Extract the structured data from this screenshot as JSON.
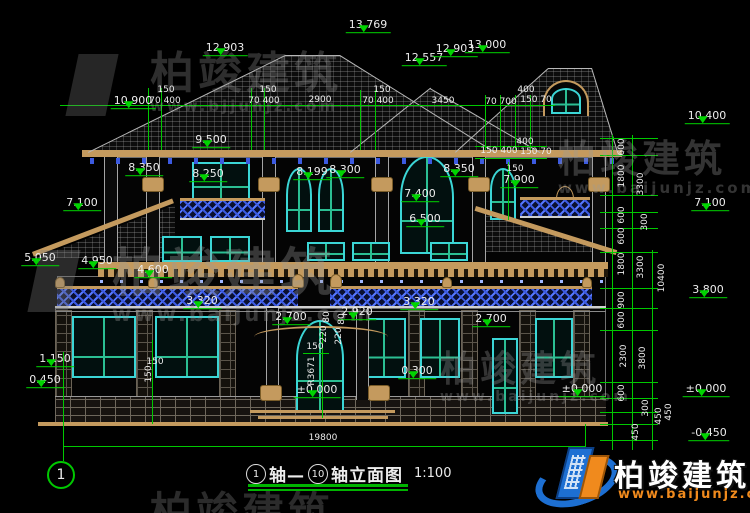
{
  "page": {
    "background": "#000000"
  },
  "colors": {
    "dim_green": "#00d400",
    "text_white": "#ececec",
    "tan_trim": "#c49a5e",
    "window_cyan": "#3bd6d6",
    "mullion_green": "#2bbf93",
    "railing_blue": "#3c5ae0",
    "logo_blue": "#1d6fd2",
    "logo_orange": "#f08a1d"
  },
  "annotations": {
    "elevations": [
      {
        "t": "13.769",
        "x": 368,
        "y": 33
      },
      {
        "t": "12.903",
        "x": 225,
        "y": 56
      },
      {
        "t": "12.557",
        "x": 424,
        "y": 66
      },
      {
        "t": "12.903",
        "x": 455,
        "y": 57
      },
      {
        "t": "13.000",
        "x": 487,
        "y": 53
      },
      {
        "t": "10.900",
        "x": 133,
        "y": 109
      },
      {
        "t": "10.400",
        "x": 707,
        "y": 124
      },
      {
        "t": "9.500",
        "x": 211,
        "y": 148
      },
      {
        "t": "8.350",
        "x": 144,
        "y": 176
      },
      {
        "t": "8.250",
        "x": 208,
        "y": 182
      },
      {
        "t": "8.199",
        "x": 312,
        "y": 180
      },
      {
        "t": "8.300",
        "x": 345,
        "y": 178
      },
      {
        "t": "8.350",
        "x": 459,
        "y": 177
      },
      {
        "t": "7.900",
        "x": 519,
        "y": 188
      },
      {
        "t": "7.100",
        "x": 82,
        "y": 211
      },
      {
        "t": "7.100",
        "x": 710,
        "y": 211
      },
      {
        "t": "7.400",
        "x": 420,
        "y": 202
      },
      {
        "t": "6.500",
        "x": 425,
        "y": 227
      },
      {
        "t": "5.050",
        "x": 40,
        "y": 266
      },
      {
        "t": "4.950",
        "x": 97,
        "y": 269
      },
      {
        "t": "4.600",
        "x": 153,
        "y": 278
      },
      {
        "t": "3.800",
        "x": 708,
        "y": 298
      },
      {
        "t": "3.320",
        "x": 202,
        "y": 309
      },
      {
        "t": "3.320",
        "x": 419,
        "y": 310
      },
      {
        "t": "2.920",
        "x": 357,
        "y": 320
      },
      {
        "t": "2.700",
        "x": 291,
        "y": 325
      },
      {
        "t": "2.700",
        "x": 491,
        "y": 327
      },
      {
        "t": "1.150",
        "x": 55,
        "y": 367
      },
      {
        "t": "0.450",
        "x": 45,
        "y": 388
      },
      {
        "t": "0.300",
        "x": 417,
        "y": 379
      },
      {
        "t": "±0.000",
        "x": 317,
        "y": 398
      },
      {
        "t": "±0.000",
        "x": 582,
        "y": 397
      },
      {
        "t": "±0.000",
        "x": 706,
        "y": 397
      },
      {
        "t": "-0.450",
        "x": 709,
        "y": 441
      }
    ],
    "dims": [
      {
        "t": "150",
        "x": 166,
        "y": 90
      },
      {
        "t": "70 400",
        "x": 165,
        "y": 101
      },
      {
        "t": "150",
        "x": 268,
        "y": 90
      },
      {
        "t": "70 400",
        "x": 264,
        "y": 101
      },
      {
        "t": "2900",
        "x": 320,
        "y": 100
      },
      {
        "t": "150",
        "x": 382,
        "y": 90
      },
      {
        "t": "70 400",
        "x": 378,
        "y": 101
      },
      {
        "t": "3450",
        "x": 443,
        "y": 101
      },
      {
        "t": "70 700",
        "x": 501,
        "y": 102
      },
      {
        "t": "400",
        "x": 526,
        "y": 90
      },
      {
        "t": "150 70",
        "x": 536,
        "y": 100
      },
      {
        "t": "400",
        "x": 525,
        "y": 142
      },
      {
        "t": "150 400",
        "x": 499,
        "y": 151
      },
      {
        "t": "150 70",
        "x": 536,
        "y": 152
      },
      {
        "t": "150",
        "x": 515,
        "y": 169
      },
      {
        "t": "150",
        "x": 315,
        "y": 347
      },
      {
        "t": "150",
        "x": 155,
        "y": 362
      },
      {
        "t": "19800",
        "x": 323,
        "y": 438
      }
    ],
    "dims_rotated": [
      {
        "t": "600",
        "x": 622,
        "y": 147
      },
      {
        "t": "1800",
        "x": 622,
        "y": 176
      },
      {
        "t": "600",
        "x": 622,
        "y": 215
      },
      {
        "t": "600",
        "x": 622,
        "y": 236
      },
      {
        "t": "1800",
        "x": 622,
        "y": 264
      },
      {
        "t": "900",
        "x": 622,
        "y": 300
      },
      {
        "t": "600",
        "x": 622,
        "y": 320
      },
      {
        "t": "2300",
        "x": 624,
        "y": 356
      },
      {
        "t": "600",
        "x": 622,
        "y": 393
      },
      {
        "t": "450",
        "x": 636,
        "y": 432
      },
      {
        "t": "3300",
        "x": 641,
        "y": 184
      },
      {
        "t": "300",
        "x": 645,
        "y": 222
      },
      {
        "t": "3300",
        "x": 641,
        "y": 267
      },
      {
        "t": "3800",
        "x": 643,
        "y": 358
      },
      {
        "t": "300",
        "x": 646,
        "y": 408
      },
      {
        "t": "450",
        "x": 659,
        "y": 416
      },
      {
        "t": "450",
        "x": 669,
        "y": 412
      },
      {
        "t": "10400",
        "x": 662,
        "y": 278
      },
      {
        "t": "150",
        "x": 149,
        "y": 374
      },
      {
        "t": "R3671",
        "x": 312,
        "y": 371
      },
      {
        "t": "80",
        "x": 327,
        "y": 317
      },
      {
        "t": "220",
        "x": 324,
        "y": 334
      },
      {
        "t": "80",
        "x": 342,
        "y": 319
      },
      {
        "t": "220",
        "x": 339,
        "y": 336
      }
    ]
  },
  "watermarks": [
    {
      "text": "柏竣建筑",
      "sub": "www.bjjunjz.com",
      "x": 150,
      "y": 52,
      "size": 44,
      "sub_size": 15,
      "opacity": 0.3,
      "glyph": true
    },
    {
      "text": "柏竣建筑",
      "sub": "www.baijunjz.com",
      "x": 558,
      "y": 140,
      "size": 38,
      "sub_size": 15,
      "opacity": 0.33,
      "glyph": false
    },
    {
      "text": "柏竣建筑",
      "sub": "www.baijunjz.com",
      "x": 112,
      "y": 248,
      "size": 52,
      "sub_size": 21,
      "opacity": 0.34,
      "glyph": true
    },
    {
      "text": "柏竣建筑",
      "sub": "www.baijunjz.com",
      "x": 440,
      "y": 352,
      "size": 36,
      "sub_size": 14,
      "opacity": 0.32,
      "glyph": false
    },
    {
      "text": "柏竣建筑",
      "sub": "",
      "x": 150,
      "y": 492,
      "size": 42,
      "sub_size": 0,
      "opacity": 0.28,
      "glyph": false
    }
  ],
  "axis_bubbles": [
    {
      "label": "1",
      "x": 61,
      "y": 475,
      "r": 14,
      "ring": "#00c800",
      "font": 14
    },
    {
      "label": "10",
      "x": 586,
      "y": 486,
      "r": 12,
      "ring": "#00c800",
      "font": 10
    }
  ],
  "title_block": {
    "axis_a": "1",
    "seg1": "轴—",
    "axis_b": "10",
    "seg2": "轴立面图",
    "scale": "1:100"
  },
  "logo": {
    "name": "柏竣建筑",
    "url": "www.baijunjz.com"
  }
}
